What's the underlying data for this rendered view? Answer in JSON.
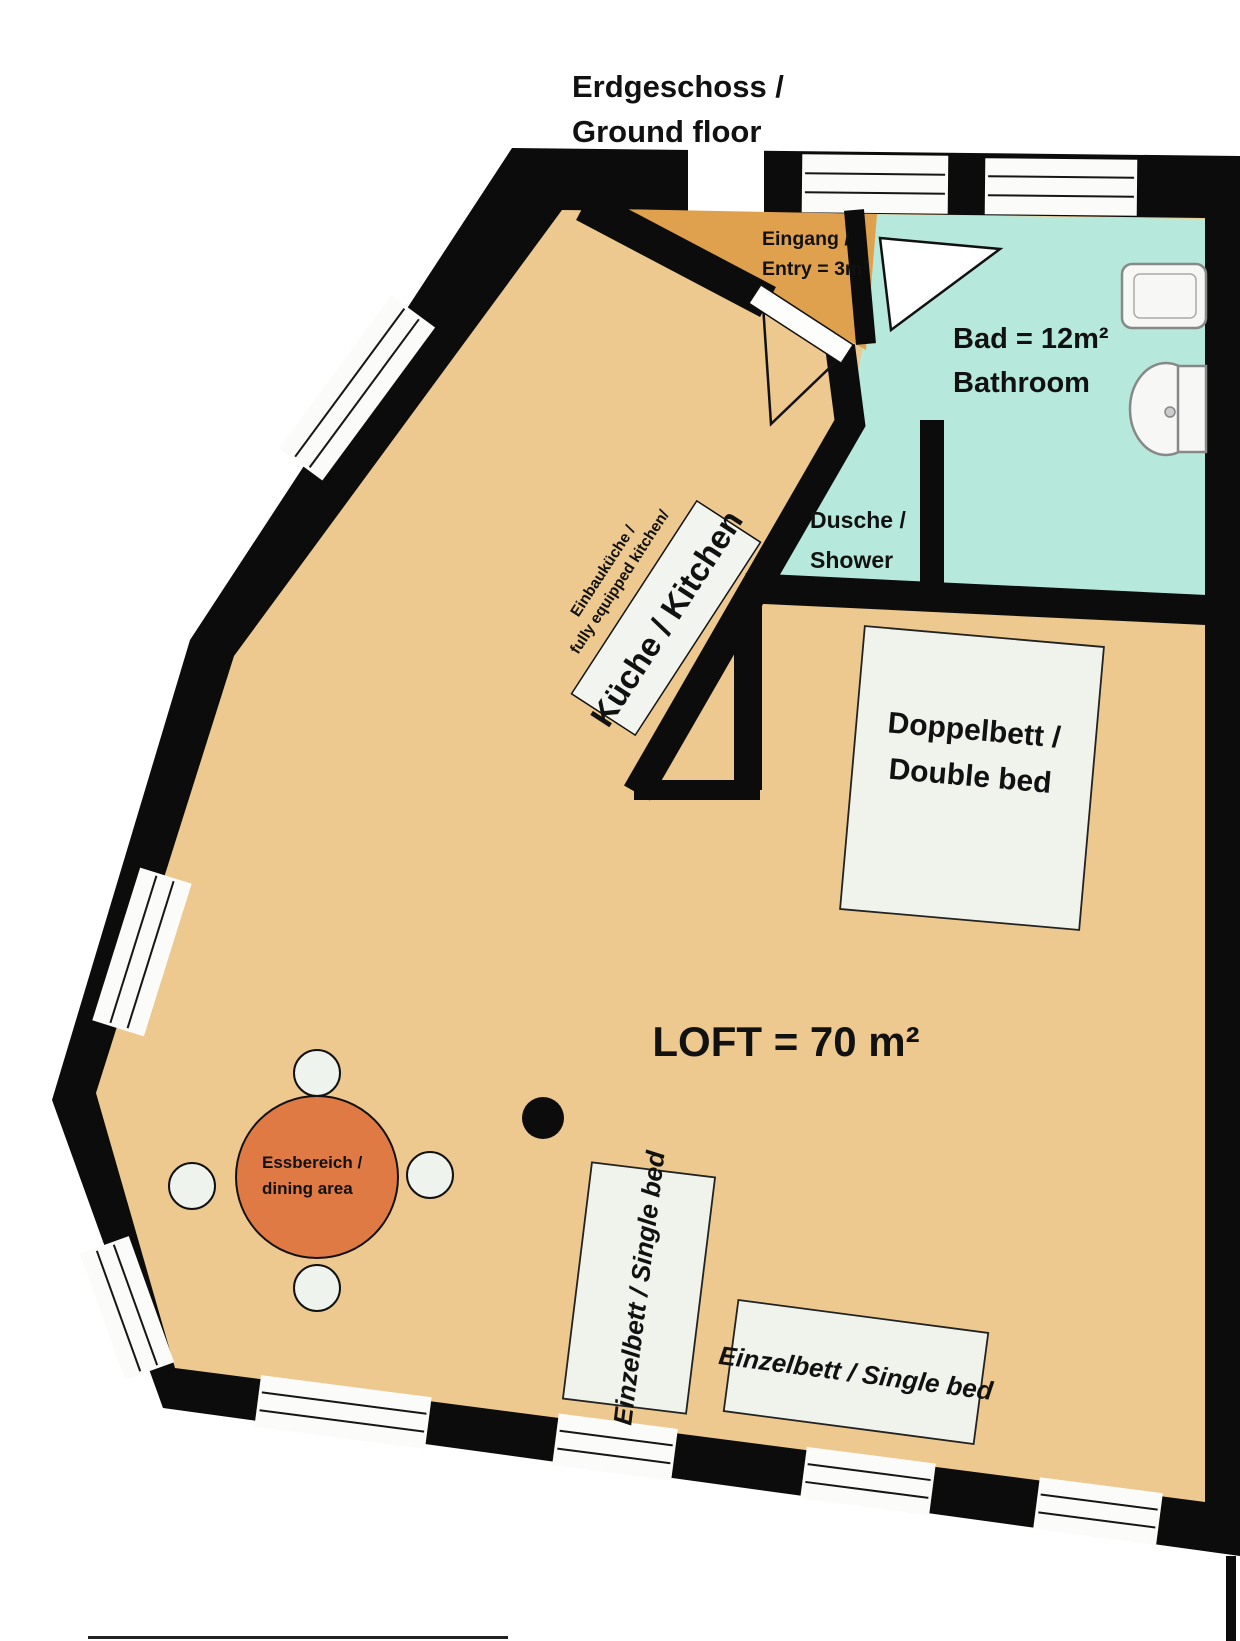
{
  "title": {
    "line1": "Erdgeschoss /",
    "line2": "Ground floor"
  },
  "rooms": {
    "loft": {
      "label": "LOFT = 70 m²"
    },
    "entry": {
      "line1": "Eingang /",
      "line2": "Entry = 3m²"
    },
    "bathroom": {
      "line1": "Bad = 12m²",
      "line2": "Bathroom"
    },
    "shower": {
      "line1": "Dusche /",
      "line2": "Shower"
    },
    "kitchen": {
      "label": "Küche / Kitchen",
      "sub1": "Einbauküche /",
      "sub2": "fully equipped kitchen/"
    },
    "dining": {
      "line1": "Essbereich  /",
      "line2": "dining area"
    }
  },
  "furniture": {
    "double_bed": {
      "line1": "Doppelbett /",
      "line2": "Double bed"
    },
    "single_bed_1": {
      "label": "Einzelbett / Single bed"
    },
    "single_bed_2": {
      "label": "Einzelbett / Single bed"
    }
  },
  "colors": {
    "wall": "#0c0c0c",
    "floor": "#edc88f",
    "entry": "#e0a14f",
    "bathroom": "#b6e9dc",
    "dining_table": "#e07a45",
    "furniture_fill": "#eff3ec",
    "window": "#fbfbf9"
  }
}
